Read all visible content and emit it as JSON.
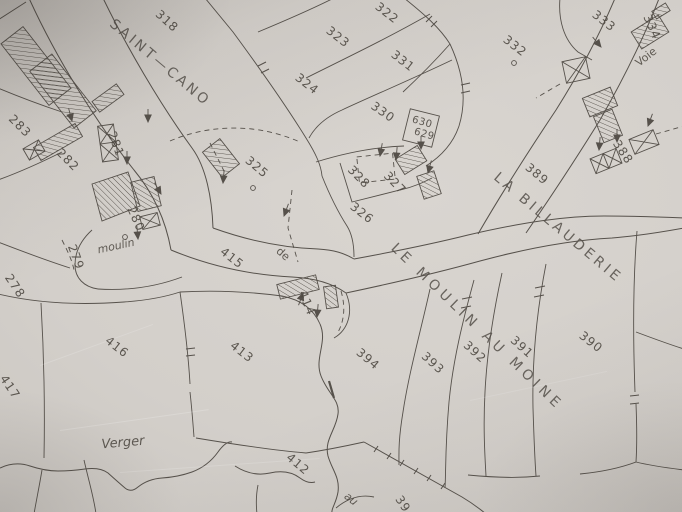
{
  "map": {
    "description": "Scanned paper cadastral map sheet (photograph)",
    "colors": {
      "paper": "#d3cfca",
      "ink": "#56514b"
    },
    "place_names": [
      "SAINT—CANO",
      "LA BILLAUDERIE",
      "LE MOULIN AU MOINE"
    ],
    "road_labels": [
      "Voie",
      "de",
      "moulin",
      "Verger",
      "au"
    ],
    "parcel_numbers": [
      "278",
      "279",
      "280",
      "281",
      "282",
      "283",
      "318",
      "322",
      "323",
      "324",
      "325",
      "326",
      "327",
      "328",
      "330",
      "331",
      "332",
      "333",
      "334",
      "388",
      "389",
      "390",
      "391",
      "392",
      "393",
      "394",
      "412",
      "413",
      "414",
      "415",
      "416",
      "417",
      "629",
      "630",
      "39"
    ],
    "labels": [
      {
        "id": "place-saint-cano",
        "text": "SAINT—CANO",
        "x": 160,
        "y": 63,
        "r": 40,
        "cls": "place-sc"
      },
      {
        "id": "place-la-billauderie",
        "text": "LA BILLAUDERIE",
        "x": 558,
        "y": 228,
        "r": 40,
        "cls": "place-lb"
      },
      {
        "id": "place-le-moulin-au-moine",
        "text": "LE MOULIN AU MOINE",
        "x": 477,
        "y": 327,
        "r": 44,
        "cls": "place-mm"
      },
      {
        "id": "road-voie",
        "text": "Voie",
        "x": 646,
        "y": 57,
        "r": -38,
        "cls": "road"
      },
      {
        "id": "road-de",
        "text": "de",
        "x": 283,
        "y": 254,
        "r": 42,
        "cls": "road"
      },
      {
        "id": "road-moulin",
        "text": "moulin",
        "x": 116,
        "y": 246,
        "r": -12,
        "cls": "road-i"
      },
      {
        "id": "road-verger",
        "text": "Verger",
        "x": 123,
        "y": 443,
        "r": -5,
        "cls": "road-i-lg"
      },
      {
        "id": "road-au",
        "text": "au",
        "x": 351,
        "y": 499,
        "r": 38,
        "cls": "road-i"
      },
      {
        "id": "parcel-318",
        "text": "318",
        "x": 167,
        "y": 21,
        "r": 42,
        "cls": "parcel"
      },
      {
        "id": "parcel-322",
        "text": "322",
        "x": 387,
        "y": 13,
        "r": 38,
        "cls": "parcel"
      },
      {
        "id": "parcel-323",
        "text": "323",
        "x": 338,
        "y": 37,
        "r": 38,
        "cls": "parcel"
      },
      {
        "id": "parcel-324",
        "text": "324",
        "x": 307,
        "y": 84,
        "r": 38,
        "cls": "parcel"
      },
      {
        "id": "parcel-325",
        "text": "325",
        "x": 257,
        "y": 167,
        "r": 40,
        "cls": "parcel"
      },
      {
        "id": "parcel-326",
        "text": "326",
        "x": 362,
        "y": 213,
        "r": 38,
        "cls": "parcel"
      },
      {
        "id": "parcel-327",
        "text": "327",
        "x": 395,
        "y": 183,
        "r": 46,
        "cls": "parcel"
      },
      {
        "id": "parcel-328",
        "text": "328",
        "x": 359,
        "y": 177,
        "r": 46,
        "cls": "parcel"
      },
      {
        "id": "parcel-630",
        "text": "630",
        "x": 422,
        "y": 123,
        "r": 16,
        "cls": "parcel-sm"
      },
      {
        "id": "parcel-629",
        "text": "629",
        "x": 424,
        "y": 135,
        "r": 16,
        "cls": "parcel-sm"
      },
      {
        "id": "parcel-330",
        "text": "330",
        "x": 383,
        "y": 112,
        "r": 35,
        "cls": "parcel"
      },
      {
        "id": "parcel-331",
        "text": "331",
        "x": 403,
        "y": 61,
        "r": 38,
        "cls": "parcel"
      },
      {
        "id": "parcel-332",
        "text": "332",
        "x": 515,
        "y": 46,
        "r": 38,
        "cls": "parcel"
      },
      {
        "id": "parcel-333",
        "text": "333",
        "x": 604,
        "y": 21,
        "r": 38,
        "cls": "parcel"
      },
      {
        "id": "parcel-334",
        "text": "334",
        "x": 652,
        "y": 27,
        "r": 66,
        "cls": "parcel"
      },
      {
        "id": "parcel-388",
        "text": "388",
        "x": 623,
        "y": 152,
        "r": 56,
        "cls": "parcel"
      },
      {
        "id": "parcel-389",
        "text": "389",
        "x": 537,
        "y": 174,
        "r": 40,
        "cls": "parcel"
      },
      {
        "id": "parcel-390",
        "text": "390",
        "x": 591,
        "y": 342,
        "r": 38,
        "cls": "parcel"
      },
      {
        "id": "parcel-391",
        "text": "391",
        "x": 522,
        "y": 347,
        "r": 42,
        "cls": "parcel"
      },
      {
        "id": "parcel-392",
        "text": "392",
        "x": 475,
        "y": 352,
        "r": 42,
        "cls": "parcel"
      },
      {
        "id": "parcel-393",
        "text": "393",
        "x": 433,
        "y": 363,
        "r": 42,
        "cls": "parcel"
      },
      {
        "id": "parcel-394",
        "text": "394",
        "x": 368,
        "y": 359,
        "r": 40,
        "cls": "parcel"
      },
      {
        "id": "parcel-39",
        "text": "39",
        "x": 403,
        "y": 504,
        "r": 56,
        "cls": "parcel"
      },
      {
        "id": "parcel-412",
        "text": "412",
        "x": 298,
        "y": 464,
        "r": 40,
        "cls": "parcel"
      },
      {
        "id": "parcel-413",
        "text": "413",
        "x": 242,
        "y": 352,
        "r": 38,
        "cls": "parcel"
      },
      {
        "id": "parcel-414",
        "text": "414",
        "x": 307,
        "y": 303,
        "r": 68,
        "cls": "parcel"
      },
      {
        "id": "parcel-415",
        "text": "415",
        "x": 232,
        "y": 258,
        "r": 38,
        "cls": "parcel"
      },
      {
        "id": "parcel-416",
        "text": "416",
        "x": 117,
        "y": 347,
        "r": 38,
        "cls": "parcel"
      },
      {
        "id": "parcel-417",
        "text": "417",
        "x": 10,
        "y": 387,
        "r": 56,
        "cls": "parcel"
      },
      {
        "id": "parcel-278",
        "text": "278",
        "x": 15,
        "y": 286,
        "r": 56,
        "cls": "parcel"
      },
      {
        "id": "parcel-279",
        "text": "279",
        "x": 76,
        "y": 257,
        "r": 70,
        "cls": "parcel"
      },
      {
        "id": "parcel-280",
        "text": "280",
        "x": 136,
        "y": 219,
        "r": 66,
        "cls": "parcel"
      },
      {
        "id": "parcel-281",
        "text": "281",
        "x": 116,
        "y": 144,
        "r": 70,
        "cls": "parcel"
      },
      {
        "id": "parcel-282",
        "text": "282",
        "x": 68,
        "y": 160,
        "r": 45,
        "cls": "parcel"
      },
      {
        "id": "parcel-283",
        "text": "283",
        "x": 20,
        "y": 126,
        "r": 45,
        "cls": "parcel"
      }
    ]
  }
}
